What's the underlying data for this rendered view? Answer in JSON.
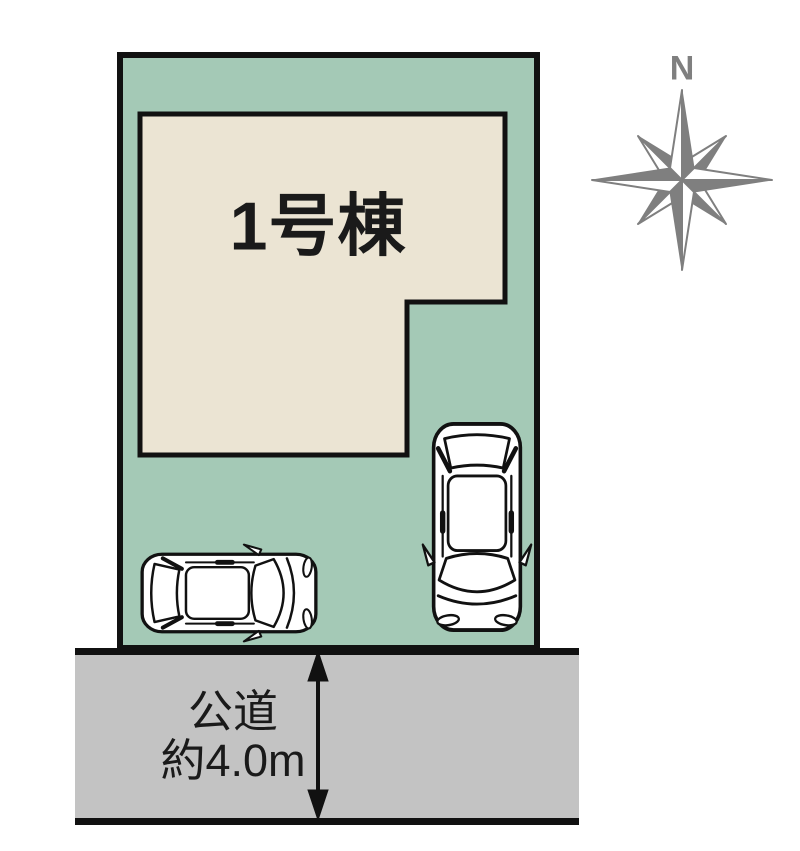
{
  "building": {
    "label": "1号棟"
  },
  "road": {
    "name_line": "公道",
    "width_line": "約4.0m"
  },
  "compass": {
    "north_label": "N"
  },
  "colors": {
    "plot_fill": "#a4c9b6",
    "building_fill": "#ebe4d3",
    "road_fill": "#c3c3c3",
    "outline": "#111111",
    "compass_gray": "#7f7f7f",
    "car_fill": "#ffffff",
    "label_text": "#1a1a1a"
  }
}
